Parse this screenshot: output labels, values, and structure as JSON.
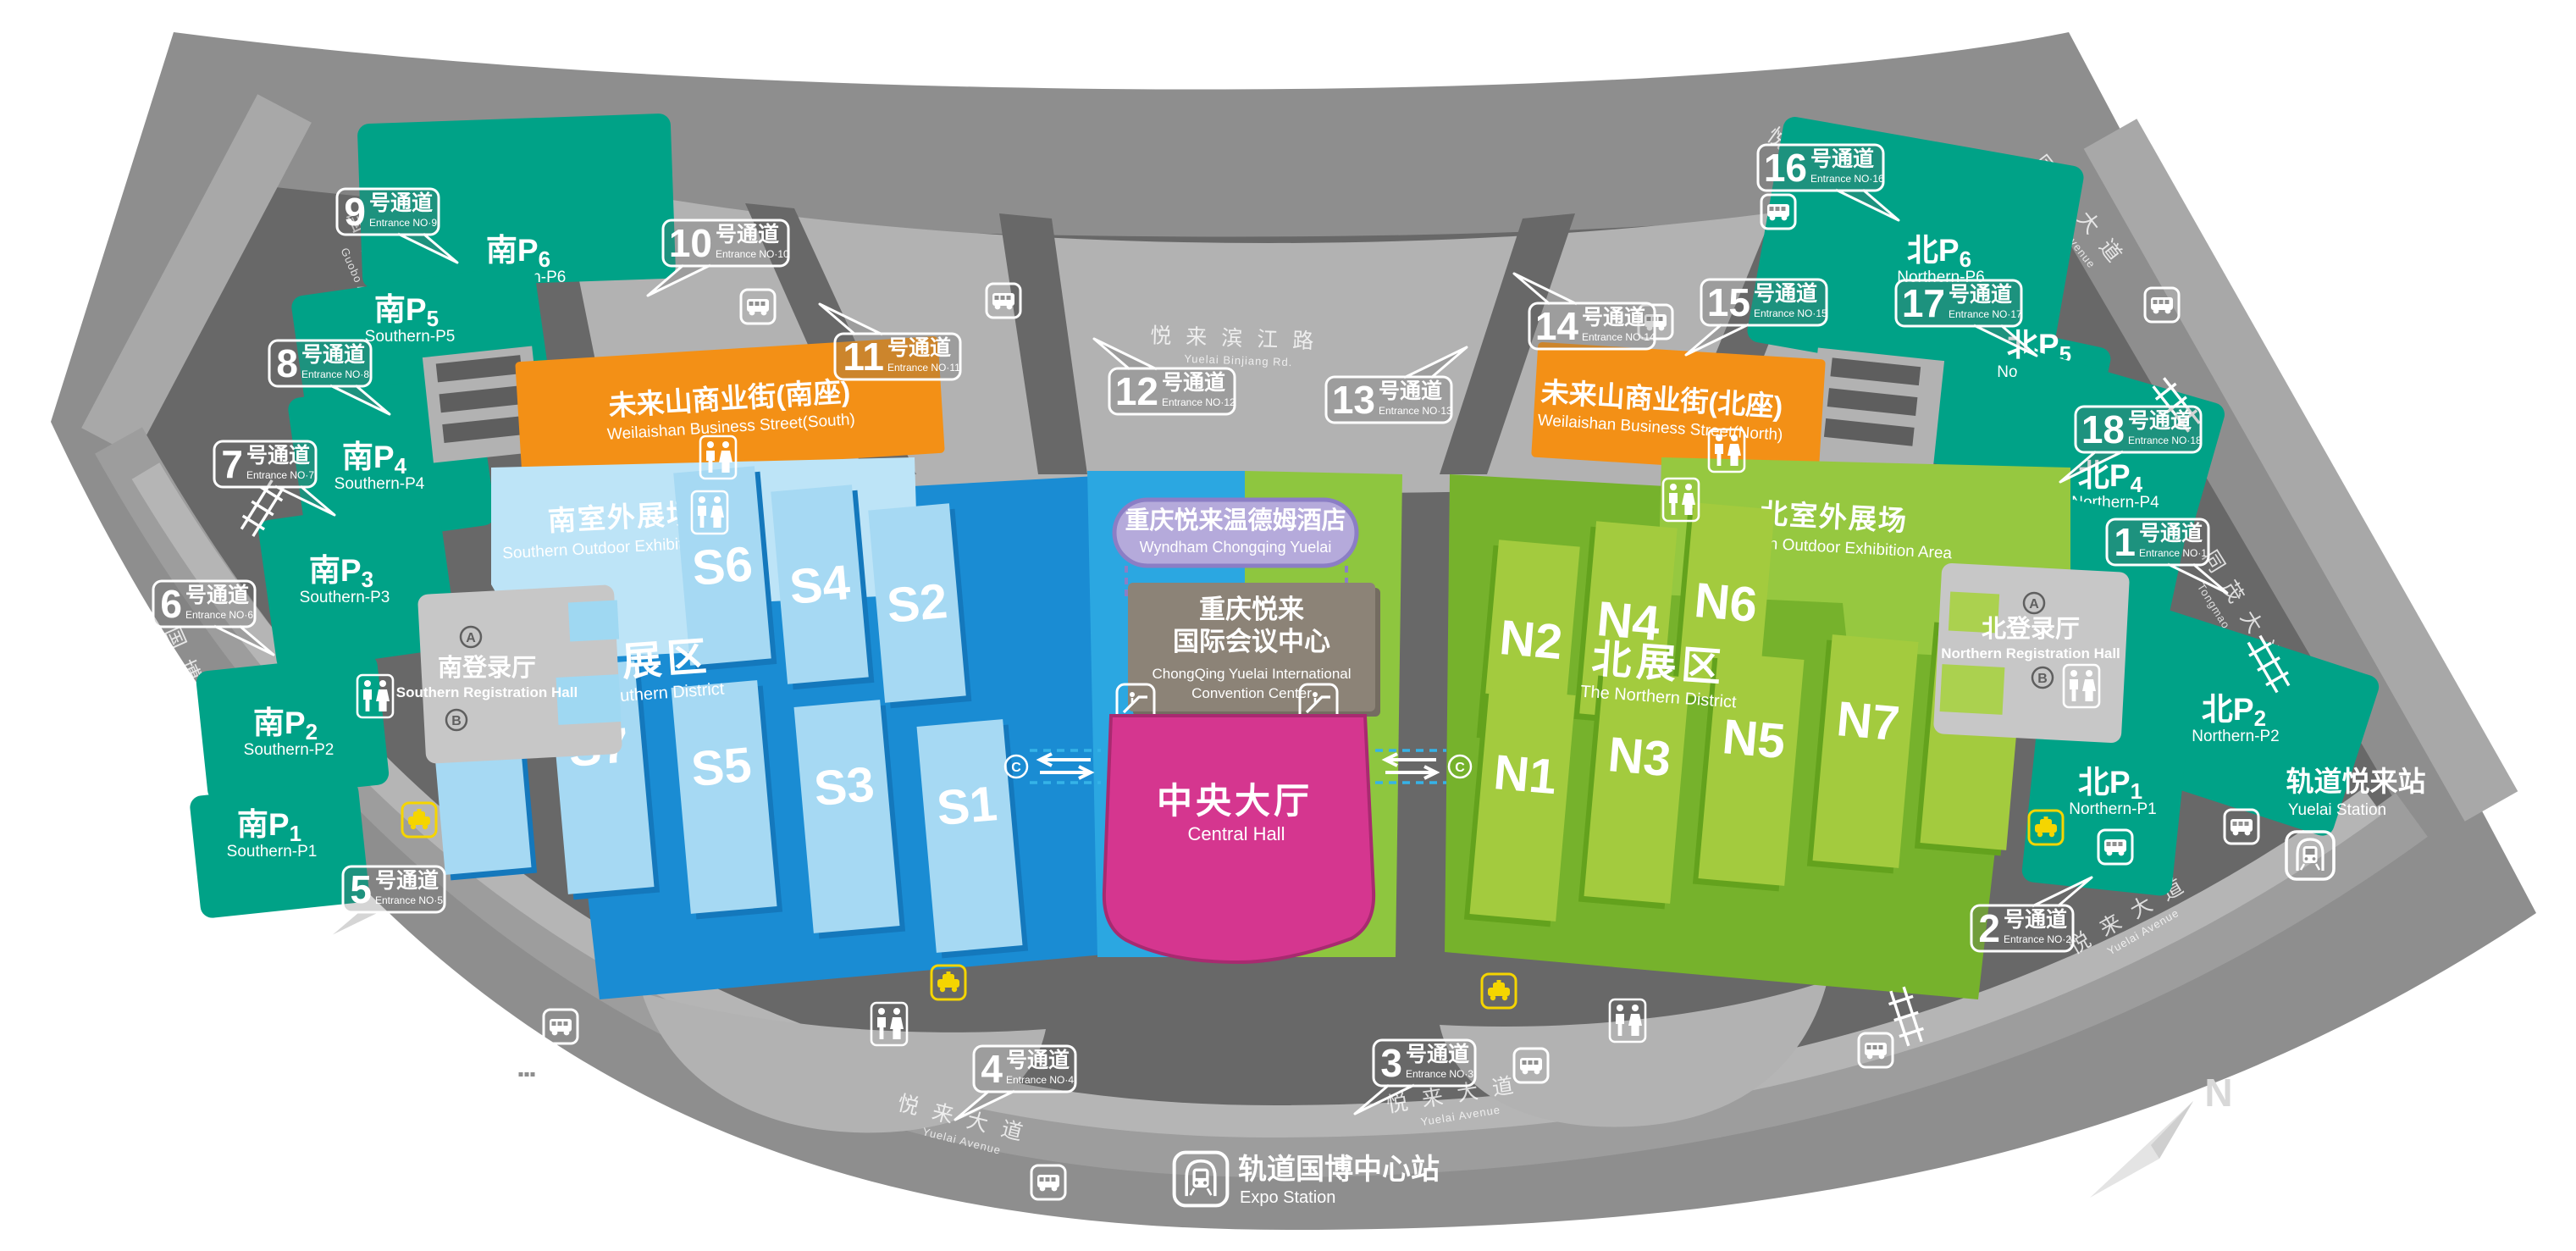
{
  "colors": {
    "fan_base": "#8e8e8e",
    "inner_dark": "#686868",
    "road_light": "#b2b2b2",
    "parking_teal": "#00a287",
    "street_orange": "#f39016",
    "south_base_blue": "#1a8cd3",
    "south_hall_blue": "#a6d9f3",
    "south_outdoor_blue": "#bde4f7",
    "north_base_green": "#76b22c",
    "north_hall_green": "#a3cb3e",
    "north_outdoor_green": "#96c840",
    "central_hall_magenta": "#d5368f",
    "hotel_purple": "#b5aadb",
    "convention_brown": "#8c8377",
    "taxi_yellow": "#f5d500"
  },
  "roads": {
    "binjiang": {
      "zh": "悦来滨江路",
      "en": "Yuelai Binjiang Rd."
    },
    "guobo": {
      "zh": "国博大道",
      "en": "Guobo Avenue"
    },
    "tongmao": {
      "zh": "同茂大道",
      "en": "Tongmao Avenue"
    },
    "yuelai": {
      "zh": "悦来大道",
      "en": "Yuelai Avenue"
    }
  },
  "entrances": [
    {
      "num": "1",
      "word": "号通道",
      "en": "Entrance NO·1"
    },
    {
      "num": "2",
      "word": "号通道",
      "en": "Entrance NO·2"
    },
    {
      "num": "3",
      "word": "号通道",
      "en": "Entrance NO·3"
    },
    {
      "num": "4",
      "word": "号通道",
      "en": "Entrance NO·4"
    },
    {
      "num": "5",
      "word": "号通道",
      "en": "Entrance NO·5"
    },
    {
      "num": "6",
      "word": "号通道",
      "en": "Entrance NO·6"
    },
    {
      "num": "7",
      "word": "号通道",
      "en": "Entrance NO·7"
    },
    {
      "num": "8",
      "word": "号通道",
      "en": "Entrance NO·8"
    },
    {
      "num": "9",
      "word": "号通道",
      "en": "Entrance NO·9"
    },
    {
      "num": "10",
      "word": "号通道",
      "en": "Entrance NO·10"
    },
    {
      "num": "11",
      "word": "号通道",
      "en": "Entrance NO·11"
    },
    {
      "num": "12",
      "word": "号通道",
      "en": "Entrance NO·12"
    },
    {
      "num": "13",
      "word": "号通道",
      "en": "Entrance NO·13"
    },
    {
      "num": "14",
      "word": "号通道",
      "en": "Entrance NO·14"
    },
    {
      "num": "15",
      "word": "号通道",
      "en": "Entrance NO·15"
    },
    {
      "num": "16",
      "word": "号通道",
      "en": "Entrance NO·16"
    },
    {
      "num": "17",
      "word": "号通道",
      "en": "Entrance NO·17"
    },
    {
      "num": "18",
      "word": "号通道",
      "en": "Entrance NO·18"
    }
  ],
  "parking": {
    "south": [
      {
        "prefix": "南P",
        "num": "1",
        "en": "Southern-P1"
      },
      {
        "prefix": "南P",
        "num": "2",
        "en": "Southern-P2"
      },
      {
        "prefix": "南P",
        "num": "3",
        "en": "Southern-P3"
      },
      {
        "prefix": "南P",
        "num": "4",
        "en": "Southern-P4"
      },
      {
        "prefix": "南P",
        "num": "5",
        "en": "Southern-P5"
      },
      {
        "prefix": "南P",
        "num": "6",
        "en": "Southern-P6"
      }
    ],
    "north": [
      {
        "prefix": "北P",
        "num": "1",
        "en": "Northern-P1"
      },
      {
        "prefix": "北P",
        "num": "2",
        "en": "Northern-P2"
      },
      {
        "prefix": "北P",
        "num": "3",
        "en": "Northern-P3"
      },
      {
        "prefix": "北P",
        "num": "4",
        "en": "Northern-P4"
      },
      {
        "prefix": "北P",
        "num": "5",
        "en": "Northern-P5"
      },
      {
        "prefix": "北P",
        "num": "6",
        "en": "Northern-P6"
      }
    ]
  },
  "halls": {
    "south": [
      "S1",
      "S2",
      "S3",
      "S4",
      "S5",
      "S6",
      "S7",
      "S8"
    ],
    "north": [
      "N1",
      "N2",
      "N3",
      "N4",
      "N5",
      "N6",
      "N7",
      "N8"
    ]
  },
  "districts": {
    "south": {
      "zh": "南展区",
      "en": "The Southern District"
    },
    "north": {
      "zh": "北展区",
      "en": "The Northern District"
    }
  },
  "outdoor": {
    "south": {
      "zh": "南室外展场",
      "en": "Southern Outdoor Exhibition Area"
    },
    "north": {
      "zh": "北室外展场",
      "en": "Northern Outdoor Exhibition Area"
    }
  },
  "registration": {
    "south": {
      "zh": "南登录厅",
      "en": "Southern Registration Hall"
    },
    "north": {
      "zh": "北登录厅",
      "en": "Northern Registration Hall"
    }
  },
  "streets": {
    "south": {
      "zh": "未来山商业街(南座)",
      "en": "Weilaishan Business Street(South)"
    },
    "north": {
      "zh": "未来山商业街(北座)",
      "en": "Weilaishan Business Street(North)"
    }
  },
  "hotel": {
    "zh": "重庆悦来温德姆酒店",
    "en": "Wyndham Chongqing Yuelai"
  },
  "convention": {
    "zh1": "重庆悦来",
    "zh2": "国际会议中心",
    "en1": "ChongQing Yuelai International",
    "en2": "Convention Center"
  },
  "central_hall": {
    "zh": "中央大厅",
    "en": "Central Hall"
  },
  "stations": {
    "expo": {
      "zh": "轨道国博中心站",
      "en": "Expo Station"
    },
    "yuelai": {
      "zh": "轨道悦来站",
      "en": "Yuelai Station"
    }
  },
  "markers": {
    "a": "A",
    "b": "B",
    "c": "C"
  },
  "compass": {
    "n": "N"
  }
}
